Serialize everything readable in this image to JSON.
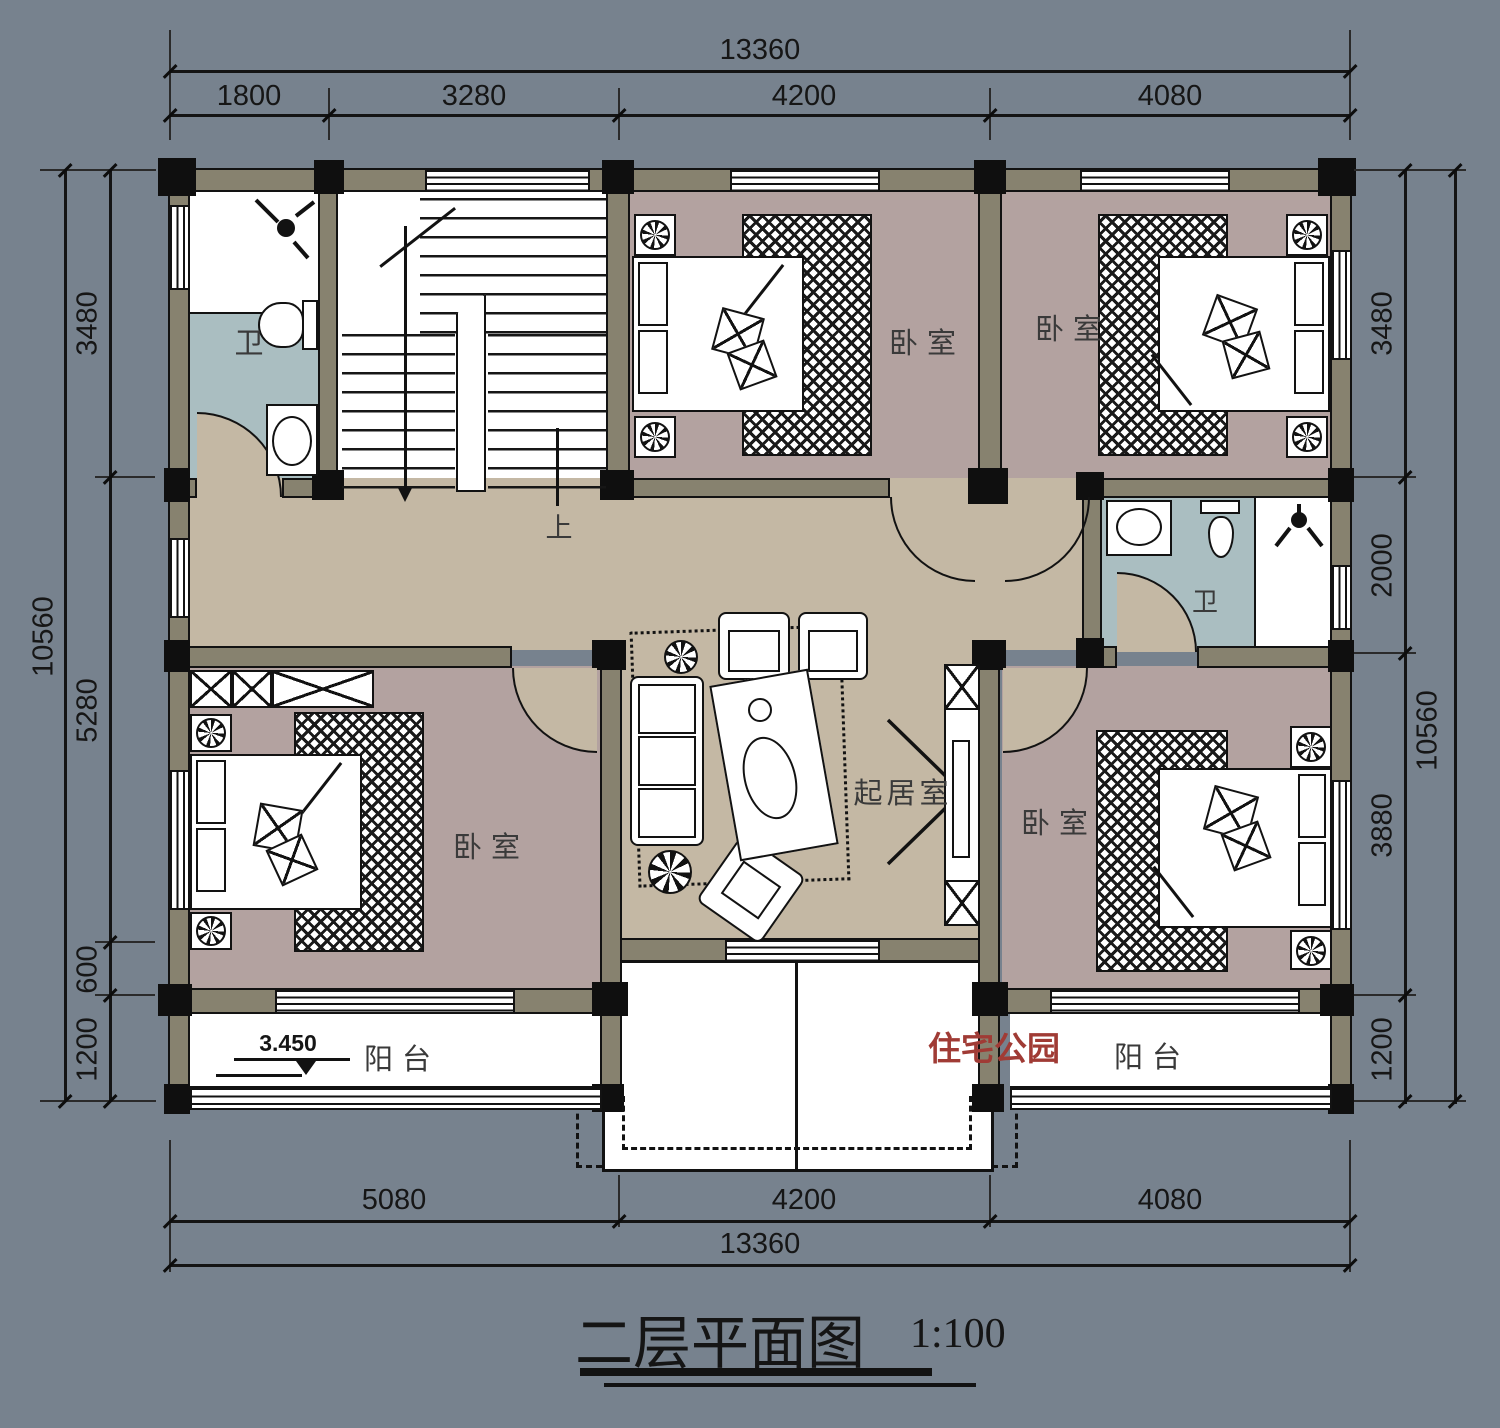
{
  "title": {
    "text": "二层平面图",
    "scale": "1:100"
  },
  "watermark": "住宅公园",
  "colors": {
    "background": "#77828E",
    "wall": "#87826F",
    "floor_hall": "#C4B8A4",
    "floor_bedroom": "#B3A2A0",
    "floor_bath": "#AABEC1",
    "watermark_red": "#A03B35",
    "line": "#121212"
  },
  "dimensions": {
    "top": {
      "total": "13360",
      "segments": [
        "1800",
        "3280",
        "4200",
        "4080"
      ]
    },
    "bottom": {
      "total": "13360",
      "segments": [
        "5080",
        "4200",
        "4080"
      ]
    },
    "left": {
      "total": "10560",
      "segments": [
        "3480",
        "5280",
        "600",
        "1200"
      ]
    },
    "right": {
      "total": "10560",
      "segments": [
        "3480",
        "2000",
        "3880",
        "1200"
      ]
    }
  },
  "rooms": {
    "bath_top_left": "卫",
    "bath_right": "卫",
    "bedroom_top_middle": "卧室",
    "bedroom_top_right": "卧室",
    "bedroom_bottom_left": "卧室",
    "bedroom_bottom_right": "卧室",
    "living": "起居室",
    "balcony_left": "阳台",
    "balcony_right": "阳台"
  },
  "annotations": {
    "stair_direction": "上",
    "balcony_elevation": "3.450"
  }
}
